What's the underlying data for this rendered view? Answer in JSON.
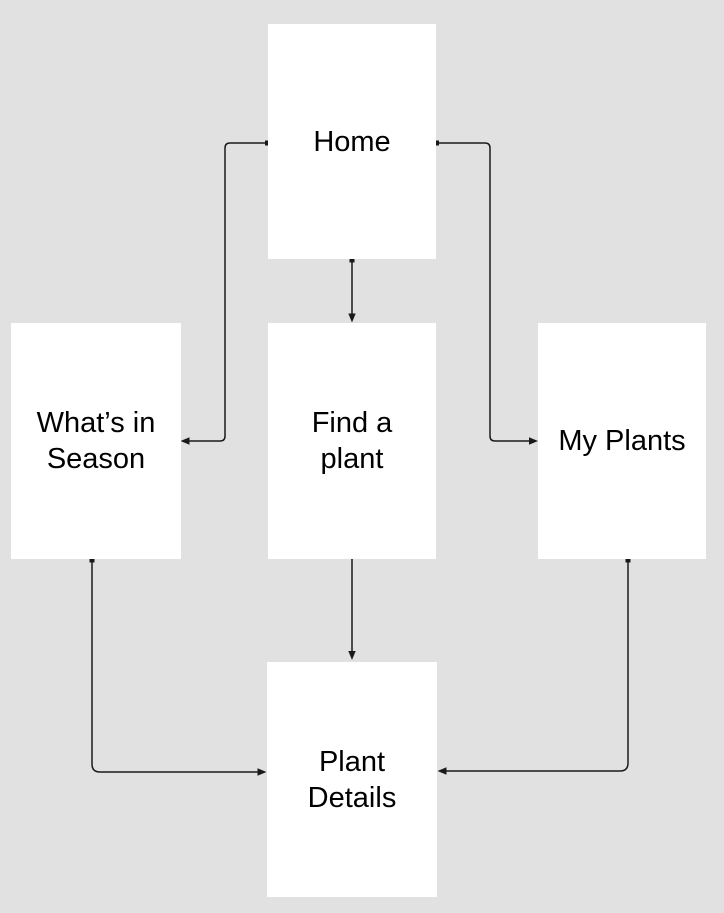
{
  "diagram": {
    "title": "Plant app navigation flowchart",
    "colors": {
      "background": "#e1e1e1",
      "node_fill": "#ffffff",
      "connector": "#1a1a1a",
      "text": "#000000"
    },
    "nodes": [
      {
        "id": "home",
        "label": "Home"
      },
      {
        "id": "whats-in-season",
        "label": "What’s in Season"
      },
      {
        "id": "find-a-plant",
        "label": "Find a plant"
      },
      {
        "id": "my-plants",
        "label": "My Plants"
      },
      {
        "id": "plant-details",
        "label": "Plant Details"
      }
    ],
    "edges": [
      {
        "from": "Home",
        "to": "What’s in Season"
      },
      {
        "from": "Home",
        "to": "Find a plant"
      },
      {
        "from": "Home",
        "to": "My Plants"
      },
      {
        "from": "Find a plant",
        "to": "Plant Details"
      },
      {
        "from": "What’s in Season",
        "to": "Plant Details"
      },
      {
        "from": "My Plants",
        "to": "Plant Details"
      }
    ]
  }
}
